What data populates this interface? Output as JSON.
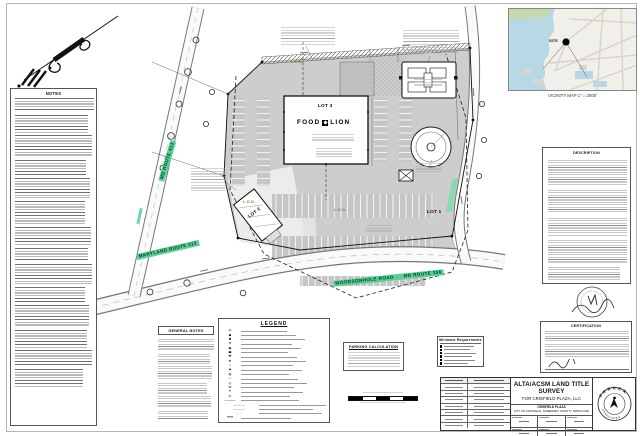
{
  "notes_panel": {
    "title": "NOTES"
  },
  "general_notes": {
    "title": "GENERAL NOTES"
  },
  "legend": {
    "title": "LEGEND",
    "symbols": [
      "⊙",
      "◆",
      "■",
      "●",
      "◉",
      "▣",
      "✚",
      "➤",
      "○",
      "▲",
      "◍",
      "□",
      "◎",
      "⊞",
      "✶",
      "∅",
      "———",
      "— — —",
      "—·—·—",
      "·······",
      "≡≡≡"
    ]
  },
  "parking_calc": {
    "title": "PARKING CALCULATION"
  },
  "requirements_table": {
    "title": "Minimum Requirements"
  },
  "plan": {
    "lot1_label": "LOT 1",
    "lot2_label": "LOT 2",
    "lot3_label": "LOT 3",
    "food_label": "FOOD",
    "lion_label": "LION",
    "lod_label": "L.O.D.",
    "roads": {
      "maryland_route_413": "MARYLAND ROUTE 413",
      "md_route_413": "MD ROUTE 413",
      "woodsonhole_road": "WOODSONHOLE ROAD",
      "md_route_358": "MD ROUTE 358"
    }
  },
  "vicinity": {
    "site_label": "SITE",
    "caption": "VICINITY MAP 1\" = 2000'"
  },
  "description_box": {
    "title": "DESCRIPTION"
  },
  "certification_box": {
    "title": "CERTIFICATION"
  },
  "title_block": {
    "title": "ALTA/ACSM LAND TITLE SURVEY",
    "subtitle": "FOR CRISFIELD PLAZA, LLC",
    "location_line1": "CRISFIELD PLAZA",
    "location_line2": "CITY OF CRISFIELD, SOMERSET COUNTY, MARYLAND",
    "logo_top": "PARKER",
    "logo_bottom": "ASSOCIATES"
  },
  "colors": {
    "highlight_green": "#55d194",
    "pavement_gray": "#cdcdcd",
    "map_water": "#b7d8e4",
    "map_green": "#c6d9ab"
  }
}
